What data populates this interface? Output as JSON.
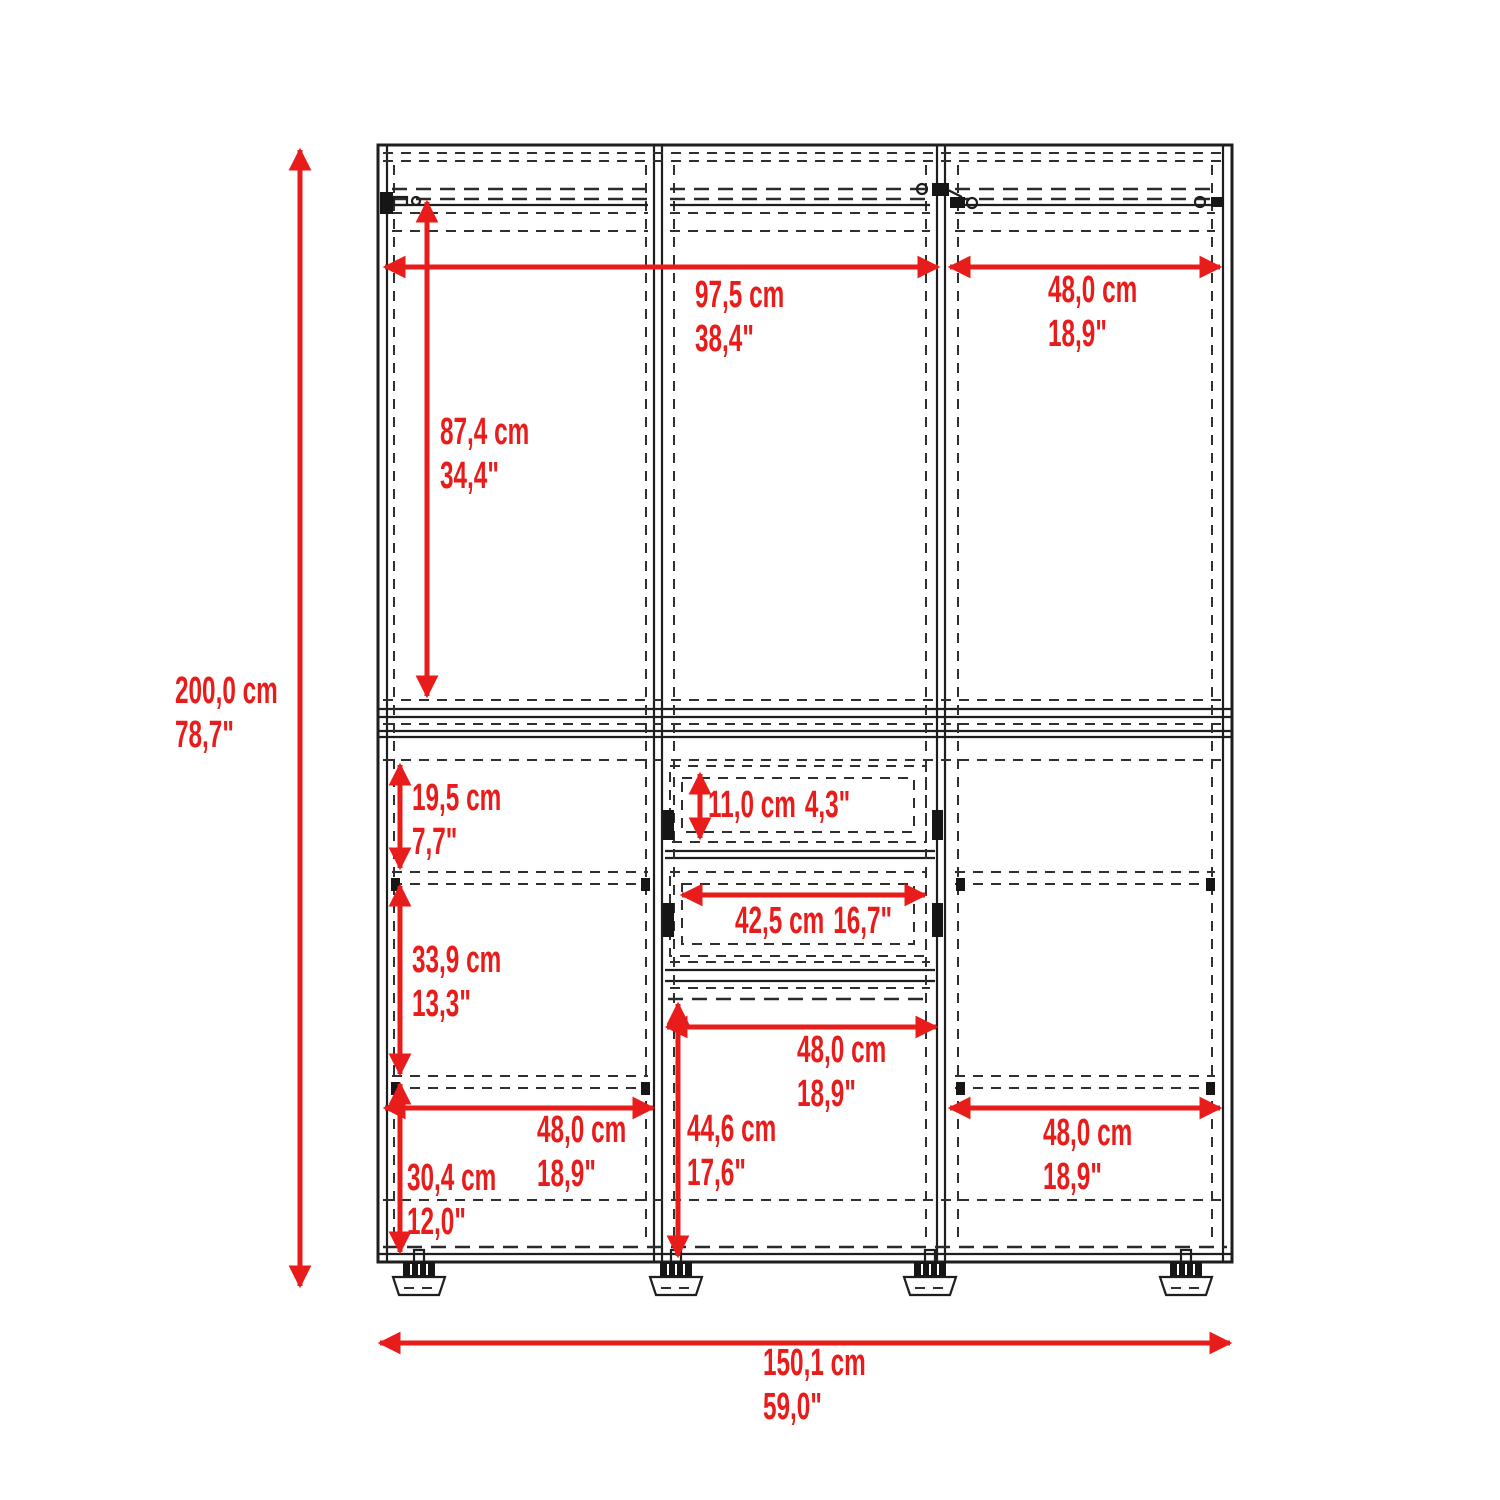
{
  "diagram": {
    "type": "furniture-dimension-drawing",
    "subject": "three-door wardrobe front elevation with red dimension callouts",
    "accent_color": "#e81c1a",
    "line_color": "#1e1e1e",
    "dimensions": {
      "overall_height": {
        "cm": "200,0 cm",
        "inches": "78,7\""
      },
      "overall_width": {
        "cm": "150,1 cm",
        "inches": "59,0\""
      },
      "upper_opening_width": {
        "cm": "97,5 cm",
        "inches": "38,4\""
      },
      "upper_right_width": {
        "cm": "48,0 cm",
        "inches": "18,9\""
      },
      "upper_section_height": {
        "cm": "87,4 cm",
        "inches": "34,4\""
      },
      "upper_shelf_space_height": {
        "cm": "19,5 cm",
        "inches": "7,7\""
      },
      "middle_shelf_space_height": {
        "cm": "33,9 cm",
        "inches": "13,3\""
      },
      "drawer_height": {
        "cm": "11,0 cm",
        "inches": "4,3\""
      },
      "drawer_width": {
        "cm": "42,5 cm",
        "inches": "16,7\""
      },
      "center_opening_width": {
        "cm": "48,0 cm",
        "inches": "18,9\""
      },
      "center_opening_height": {
        "cm": "44,6 cm",
        "inches": "17,6\""
      },
      "lower_shelf_space_height": {
        "cm": "30,4 cm",
        "inches": "12,0\""
      },
      "lower_left_width": {
        "cm": "48,0 cm",
        "inches": "18,9\""
      },
      "lower_right_width": {
        "cm": "48,0 cm",
        "inches": "18,9\""
      }
    }
  }
}
